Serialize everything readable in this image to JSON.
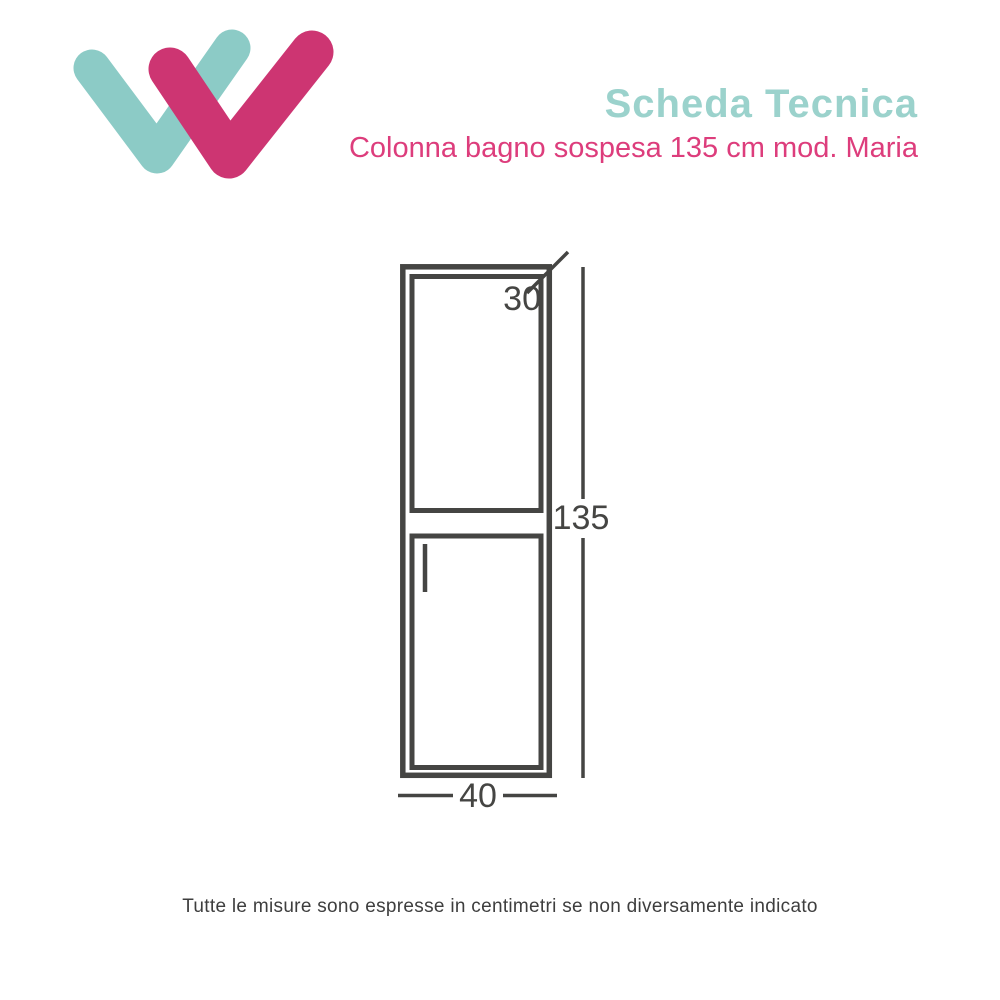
{
  "header": {
    "title": "Scheda Tecnica",
    "subtitle": "Colonna bagno sospesa 135 cm mod. Maria",
    "title_color": "#9bd2cc",
    "subtitle_color": "#dd3d7c"
  },
  "logo": {
    "description": "double checkmark W mark",
    "teal_color": "#8ccbc6",
    "pink_color": "#cd3572"
  },
  "drawing": {
    "subject": "wall-hung bathroom column cabinet, front view, two doors",
    "line_color": "#454543",
    "dimensions": {
      "depth": "30",
      "height": "135",
      "width": "40"
    }
  },
  "footer": {
    "note": "Tutte le misure sono espresse in centimetri se non diversamente indicato"
  }
}
